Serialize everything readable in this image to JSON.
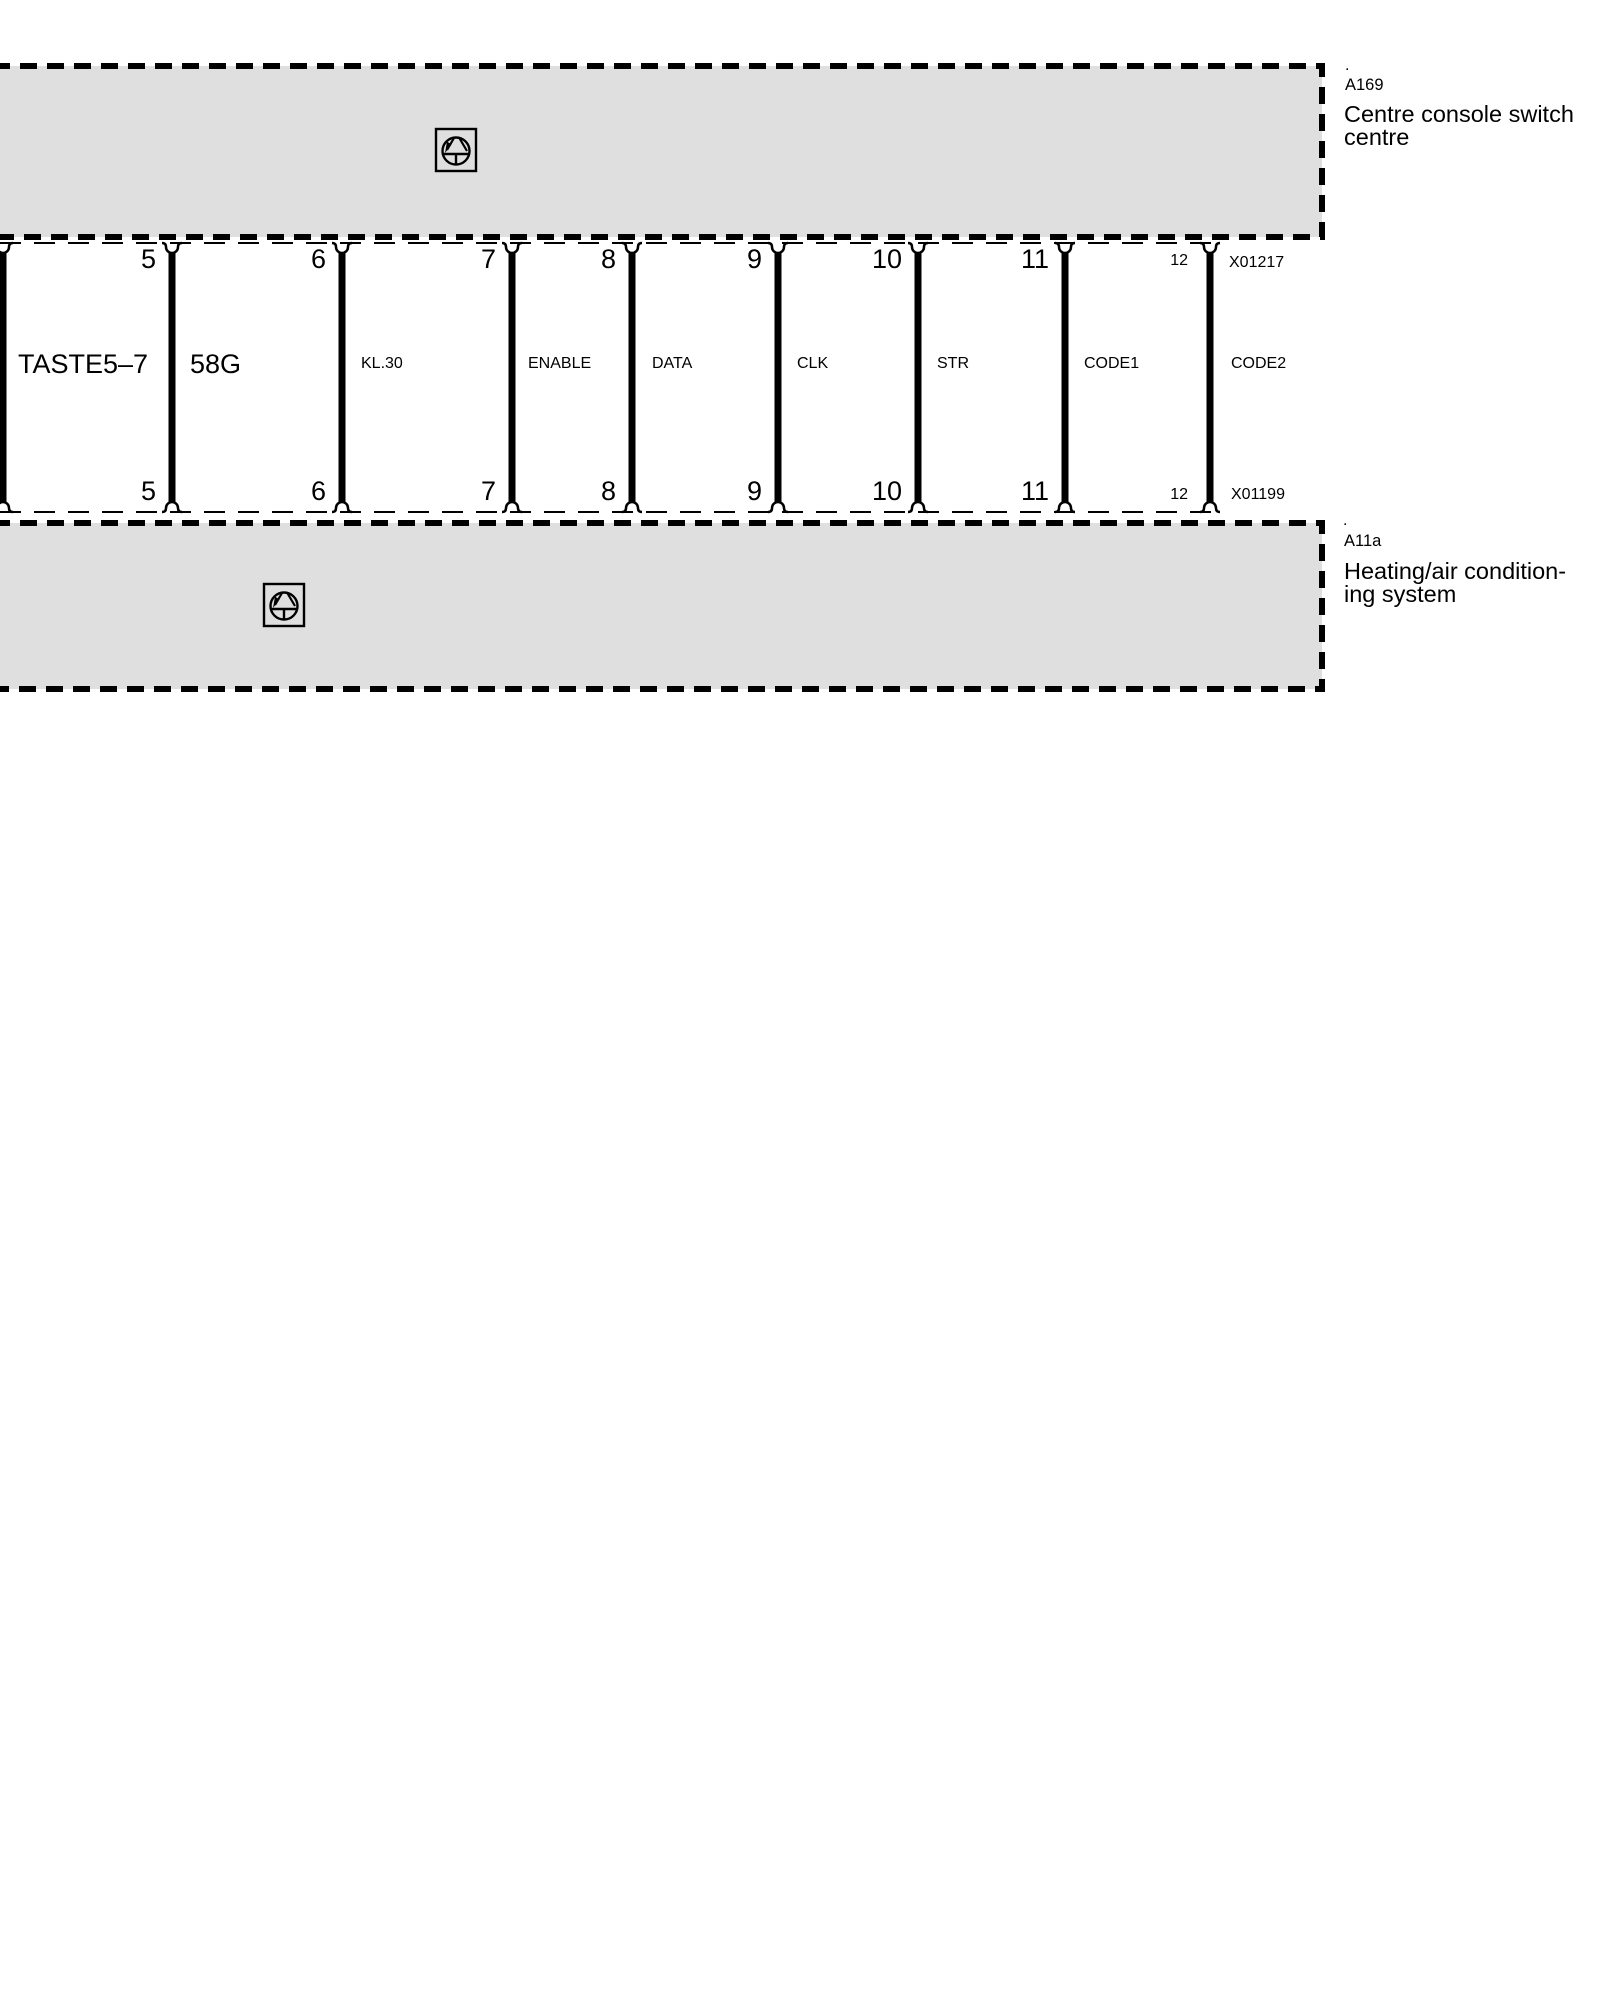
{
  "blocks": {
    "top": {
      "dot": ".",
      "code": "A169",
      "title_line1": "Centre console switch",
      "title_line2": "centre"
    },
    "bottom": {
      "dot": ".",
      "code": "A11a",
      "title_line1": "Heating/air condition-",
      "title_line2": "ing system"
    }
  },
  "connectors": {
    "top_label": "X01217",
    "bottom_label": "X01199"
  },
  "pins": {
    "top": [
      "5",
      "6",
      "7",
      "8",
      "9",
      "10",
      "11",
      "12"
    ],
    "bottom": [
      "5",
      "6",
      "7",
      "8",
      "9",
      "10",
      "11",
      "12"
    ]
  },
  "signals": [
    "TASTE5–7",
    "58G",
    "KL.30",
    "ENABLE",
    "DATA",
    "CLK",
    "STR",
    "CODE1",
    "CODE2"
  ],
  "colors": {
    "block_fill": "#dfdfdf",
    "line": "#000000"
  }
}
